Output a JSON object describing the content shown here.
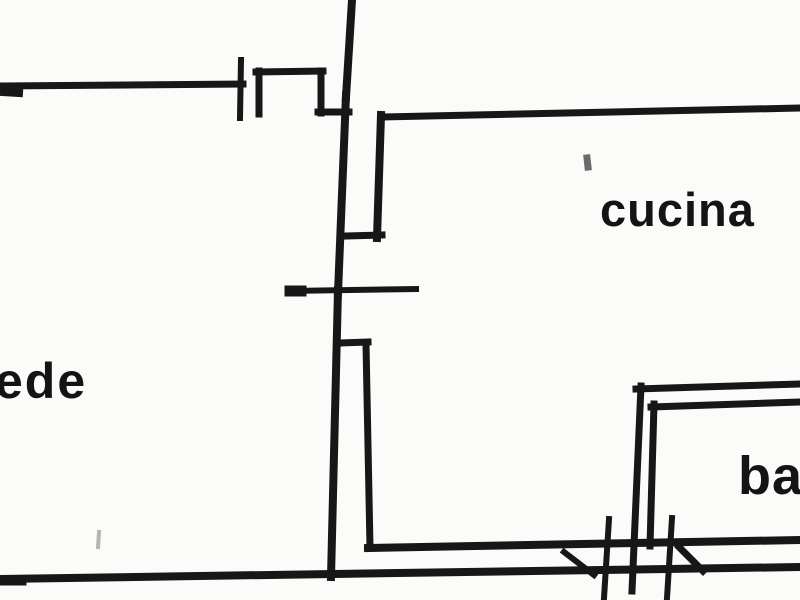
{
  "plan": {
    "background": "#fbfbf9",
    "ink": "#171717",
    "segments": [
      {
        "name": "top-center-wall-vertical",
        "x1": 352,
        "y1": 0,
        "x2": 346,
        "y2": 97,
        "w": 8
      },
      {
        "name": "upper-left-wall-horizontal",
        "x1": 0,
        "y1": 86,
        "x2": 243,
        "y2": 84,
        "w": 7
      },
      {
        "name": "upper-left-wall-end-cap",
        "x1": 3,
        "y1": 92,
        "x2": 19,
        "y2": 93,
        "w": 8
      },
      {
        "name": "door-jamb-tick-upper-left",
        "x1": 241,
        "y1": 60,
        "x2": 240,
        "y2": 118,
        "w": 6
      },
      {
        "name": "wall-notch-left-leg",
        "x1": 259,
        "y1": 71,
        "x2": 259,
        "y2": 114,
        "w": 7
      },
      {
        "name": "wall-notch-top",
        "x1": 256,
        "y1": 72,
        "x2": 323,
        "y2": 71,
        "w": 7
      },
      {
        "name": "wall-notch-right-leg",
        "x1": 321,
        "y1": 71,
        "x2": 321,
        "y2": 113,
        "w": 7
      },
      {
        "name": "wall-notch-foot",
        "x1": 318,
        "y1": 112,
        "x2": 349,
        "y2": 112,
        "w": 7
      },
      {
        "name": "center-wall-mid-vertical",
        "x1": 346,
        "y1": 95,
        "x2": 338,
        "y2": 293,
        "w": 8
      },
      {
        "name": "door-opening-tick-horizontal",
        "x1": 290,
        "y1": 291,
        "x2": 416,
        "y2": 289,
        "w": 6
      },
      {
        "name": "door-opening-tick-left-cap",
        "x1": 290,
        "y1": 291,
        "x2": 301,
        "y2": 291,
        "w": 11
      },
      {
        "name": "center-wall-lower-vertical",
        "x1": 338,
        "y1": 290,
        "x2": 331,
        "y2": 577,
        "w": 8
      },
      {
        "name": "double-wall-top-jog",
        "x1": 340,
        "y1": 343,
        "x2": 368,
        "y2": 342,
        "w": 7
      },
      {
        "name": "double-wall-inner-vertical",
        "x1": 366,
        "y1": 344,
        "x2": 370,
        "y2": 547,
        "w": 7
      },
      {
        "name": "bottom-wall-inner-horizontal",
        "x1": 368,
        "y1": 548,
        "x2": 800,
        "y2": 540,
        "w": 8
      },
      {
        "name": "bottom-wall-outer-horizontal",
        "x1": 0,
        "y1": 579,
        "x2": 800,
        "y2": 567,
        "w": 8
      },
      {
        "name": "bottom-wall-left-end-cap",
        "x1": 2,
        "y1": 581,
        "x2": 22,
        "y2": 581,
        "w": 9
      },
      {
        "name": "kitchen-top-wall",
        "x1": 383,
        "y1": 117,
        "x2": 800,
        "y2": 108,
        "w": 7
      },
      {
        "name": "kitchen-left-wall-vertical",
        "x1": 381,
        "y1": 115,
        "x2": 377,
        "y2": 238,
        "w": 8
      },
      {
        "name": "kitchen-left-wall-connector",
        "x1": 346,
        "y1": 236,
        "x2": 382,
        "y2": 235,
        "w": 7
      },
      {
        "name": "bathroom-outer-top-wall",
        "x1": 636,
        "y1": 389,
        "x2": 800,
        "y2": 384,
        "w": 7
      },
      {
        "name": "bathroom-outer-left-wall",
        "x1": 641,
        "y1": 386,
        "x2": 632,
        "y2": 591,
        "w": 7
      },
      {
        "name": "bathroom-inner-top-wall",
        "x1": 651,
        "y1": 407,
        "x2": 800,
        "y2": 402,
        "w": 7
      },
      {
        "name": "bathroom-inner-left-wall",
        "x1": 654,
        "y1": 404,
        "x2": 650,
        "y2": 546,
        "w": 7
      },
      {
        "name": "door-jamb-tick-bottom-left",
        "x1": 609,
        "y1": 519,
        "x2": 604,
        "y2": 598,
        "w": 6
      },
      {
        "name": "door-jamb-tick-bottom-right",
        "x1": 672,
        "y1": 518,
        "x2": 667,
        "y2": 598,
        "w": 6
      },
      {
        "name": "wall-break-diagonal-left",
        "x1": 564,
        "y1": 552,
        "x2": 594,
        "y2": 575,
        "w": 6
      },
      {
        "name": "wall-break-diagonal-right",
        "x1": 679,
        "y1": 547,
        "x2": 703,
        "y2": 571,
        "w": 7
      }
    ],
    "speckles": [
      {
        "name": "scan-speckle-near-kitchen",
        "x1": 587,
        "y1": 158,
        "x2": 588,
        "y2": 167,
        "w": 7,
        "color": "#6b6b6b"
      },
      {
        "name": "scan-speckle-bottom-left",
        "x1": 99,
        "y1": 532,
        "x2": 98,
        "y2": 547,
        "w": 4,
        "color": "#b5b5b5"
      }
    ]
  },
  "labels": {
    "left_room_partial": "ede",
    "kitchen": "cucina",
    "bathroom_partial": "ba"
  }
}
